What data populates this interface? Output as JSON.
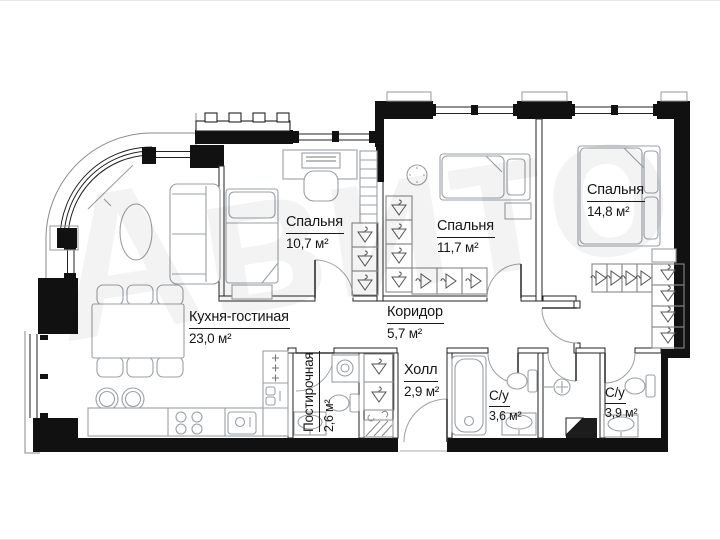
{
  "watermark": "Авито",
  "rooms": [
    {
      "id": "bedroom-1",
      "name": "Спальня",
      "area": "10,7 м²"
    },
    {
      "id": "bedroom-2",
      "name": "Спальня",
      "area": "11,7 м²"
    },
    {
      "id": "bedroom-3",
      "name": "Спальня",
      "area": "14,8 м²"
    },
    {
      "id": "kitchen-living",
      "name": "Кухня-гостиная",
      "area": "23,0 м²"
    },
    {
      "id": "corridor",
      "name": "Коридор",
      "area": "5,7 м²"
    },
    {
      "id": "laundry",
      "name": "Постирочная",
      "area": "2,6 м²"
    },
    {
      "id": "hall",
      "name": "Холл",
      "area": "2,9 м²"
    },
    {
      "id": "bathroom-1",
      "name": "С/у",
      "area": "3,6 м²"
    },
    {
      "id": "bathroom-2",
      "name": "С/у",
      "area": "3,9 м²"
    }
  ],
  "colors": {
    "wall": "#111111",
    "interior_wall_stroke": "#2a2a2a",
    "furniture_stroke": "#9aa0a4",
    "label_text": "#161616"
  }
}
